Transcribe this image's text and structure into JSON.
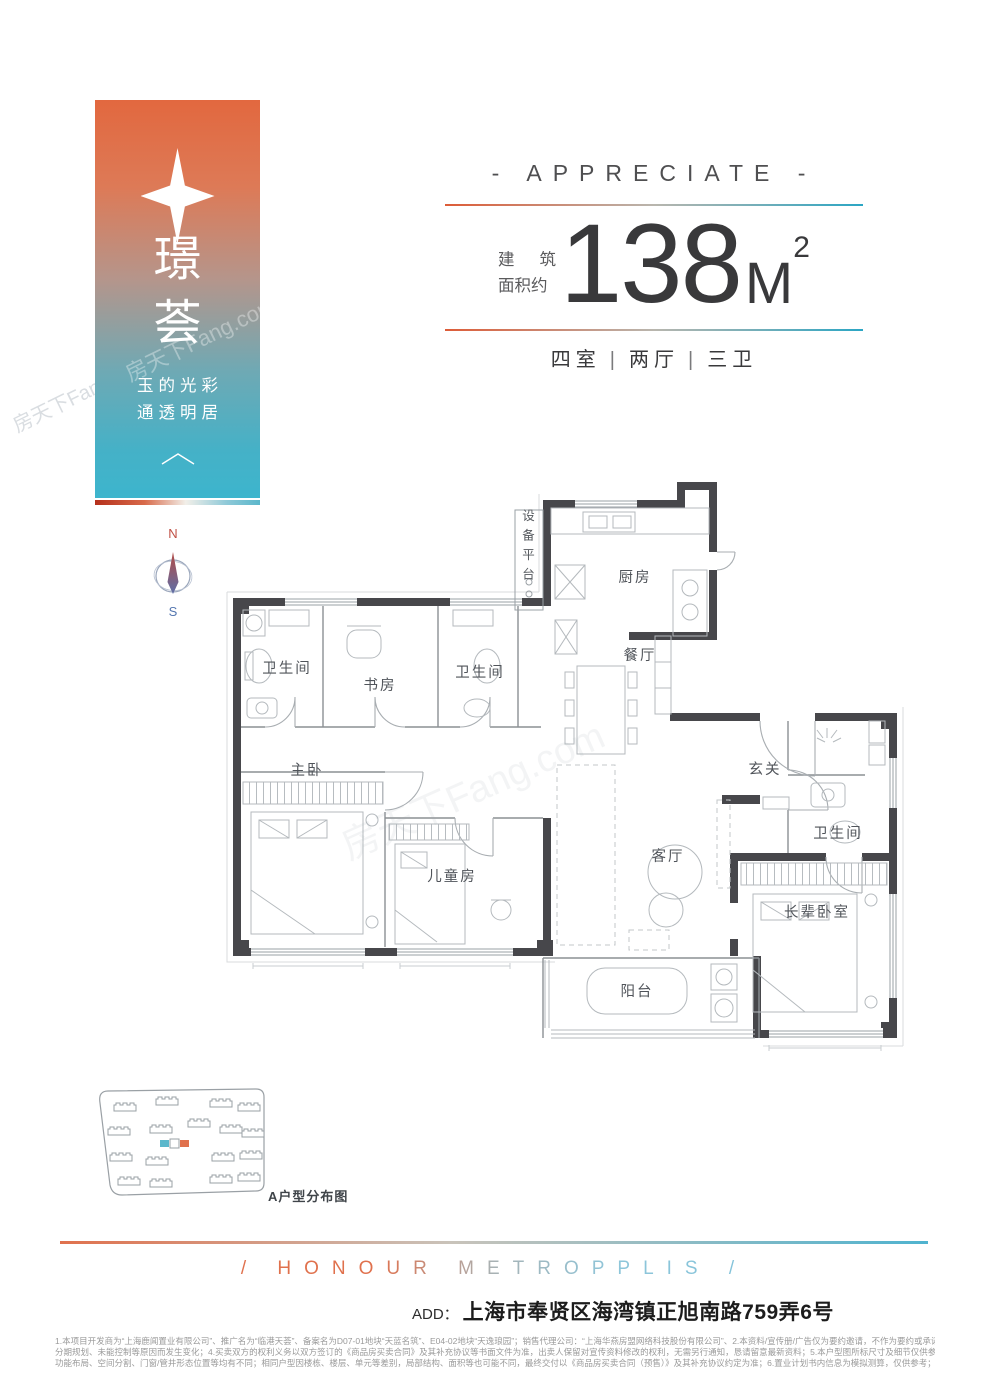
{
  "banner": {
    "title": "璟荟",
    "subtitle_line1": "玉的光彩",
    "subtitle_line2": "通透明居"
  },
  "headline": {
    "eyebrow": "- APPRECIATE -",
    "area_label_line1_a": "建",
    "area_label_line1_b": "筑",
    "area_label_line2": "面积约",
    "area_value": "138",
    "area_unit": "M",
    "area_exponent": "2",
    "spec_rooms": "四室",
    "spec_halls": "两厅",
    "spec_baths": "三卫",
    "spec_separator": "|"
  },
  "compass": {
    "north": "N",
    "south": "S"
  },
  "floorplan": {
    "rooms": [
      {
        "id": "equipment-platform",
        "label": "设备平台"
      },
      {
        "id": "kitchen",
        "label": "厨房"
      },
      {
        "id": "bathroom-1",
        "label": "卫生间"
      },
      {
        "id": "study",
        "label": "书房"
      },
      {
        "id": "bathroom-2",
        "label": "卫生间"
      },
      {
        "id": "dining-room",
        "label": "餐厅"
      },
      {
        "id": "master-bedroom",
        "label": "主卧"
      },
      {
        "id": "foyer",
        "label": "玄关"
      },
      {
        "id": "kids-room",
        "label": "儿童房"
      },
      {
        "id": "living-room",
        "label": "客厅"
      },
      {
        "id": "bathroom-3",
        "label": "卫生间"
      },
      {
        "id": "elder-bedroom",
        "label": "长辈卧室"
      },
      {
        "id": "balcony",
        "label": "阳台"
      }
    ]
  },
  "siteplan": {
    "caption": "A户型分布图",
    "highlight_left_color": "#5bb7cb",
    "highlight_right_color": "#e0714d"
  },
  "footer": {
    "slogan": "/ HONOUR  METROPPLIS /",
    "address_label": "ADD：",
    "address": "上海市奉贤区海湾镇正旭南路759弄6号",
    "disclaimer_line1": "1.本项目开发商为“上海鹿闻置业有限公司”、推广名为“临港天荟”、备案名为D07-01地块“天蓝名筑”、E04-02地块“天逸琅园”；销售代理公司：“上海华燕房盟网络科技股份有限公司”、2.本资料/宣传册/广告仅为要约邀请，不作为要约或承诺；3.相关宣传内容不排除因政府相关规划、规定及出卖人",
    "disclaimer_line2": "分期规划、未能控制等原因而发生变化；4.买卖双方的权利义务以双方签订的《商品房买卖合同》及其补充协议等书面文件为准，出卖人保留对宣传资料修改的权利，无需另行通知，恳请留意最新资料；5.本户型图所标尺寸及细节仅供参考，其装修、家具、陈设非交付标准，不同户型的面积尺寸",
    "disclaimer_line3": "功能布局、空间分割、门窗/管井形态位置等均有不同；相同户型因楼栋、楼层、单元等差别，局部结构、面积等也可能不同，最终交付以《商品房买卖合同（预售）》及其补充协议约定为准；6.置业计划书内信息为模拟测算，仅供参考；7.本宣传资料所示内容有效期至2023年12月31日。",
    "watermark": "房天下Fang.com"
  }
}
